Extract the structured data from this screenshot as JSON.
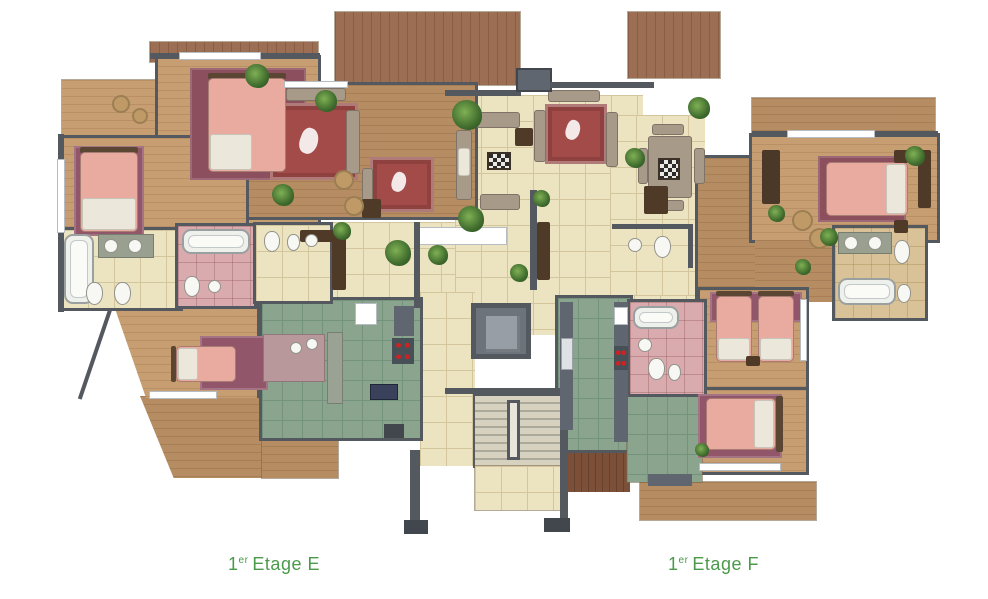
{
  "labels": {
    "e": {
      "number": "1",
      "sup": "er",
      "text": "Etage E"
    },
    "f": {
      "number": "1",
      "sup": "er",
      "text": "Etage F"
    }
  },
  "colors": {
    "wall": "#545960",
    "wallDark": "#42474d",
    "woodLight": "#c79e72",
    "woodMid": "#b68d63",
    "woodDark": "#9c6e53",
    "woodEntry": "#7c5038",
    "cream": "#ece3c1",
    "creamLine": "#d3c69c",
    "kitchenGreen": "#8aa48e",
    "kitchenGreenLine": "#74937c",
    "pinkTile": "#d9abae",
    "tanTile": "#d9c298",
    "carpetRed": "#a34b49",
    "carpetMauve": "#92566a",
    "carpetMauveDark": "#8c4f5e",
    "bedPink": "#e9aba0",
    "pillowWhite": "#ece7db",
    "sofaTaupe": "#a89a89",
    "plantGreen": "#4e7d3a",
    "elevatorGray": "#6d737b",
    "elevatorInner": "#989ea6",
    "stairLight": "#d7d1c0",
    "stairDark": "#aaa99a",
    "counterDark": "#4f3a28",
    "applianceGray": "#5f6670",
    "stoveRed": "#cc2222",
    "labelGreen": "#4a9a4a"
  }
}
